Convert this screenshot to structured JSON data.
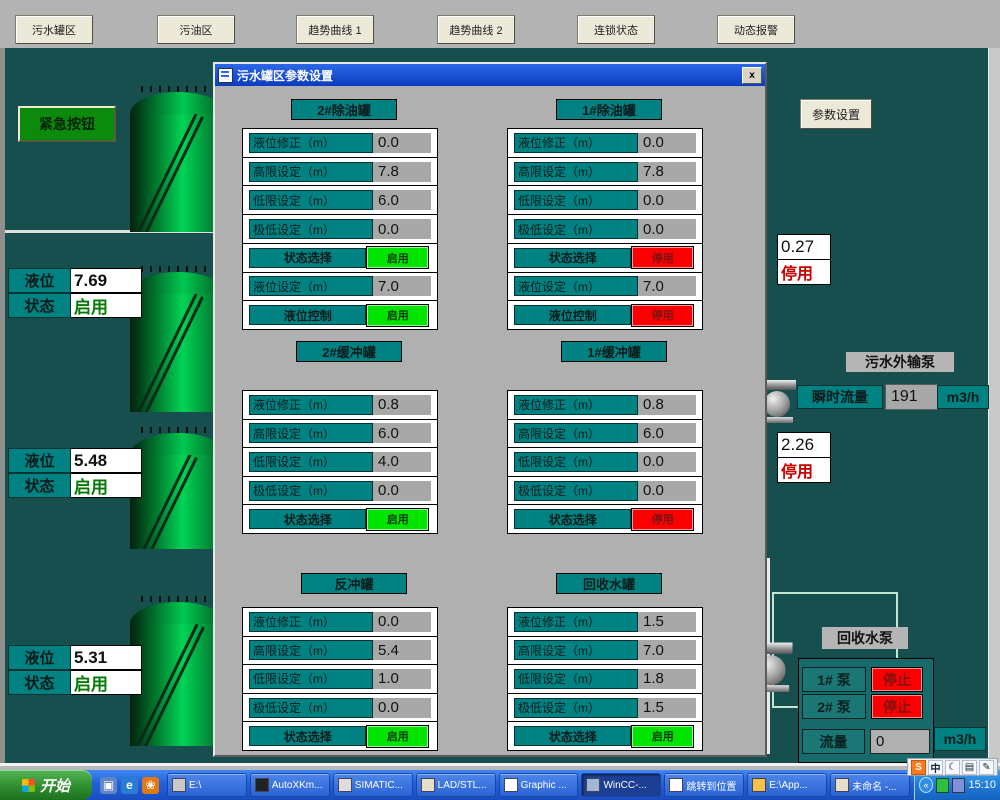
{
  "top_nav": {
    "buttons": [
      "污水罐区",
      "污油区",
      "趋势曲线 1",
      "趋势曲线 2",
      "连锁状态",
      "动态报警"
    ]
  },
  "left_panel": {
    "emergency_button": "紧急按钮",
    "tank_readouts": [
      {
        "level_label": "液位",
        "level_value": "7.69",
        "status_label": "状态",
        "status_value": "启用"
      },
      {
        "level_label": "液位",
        "level_value": "5.48",
        "status_label": "状态",
        "status_value": "启用"
      },
      {
        "level_label": "液位",
        "level_value": "5.31",
        "status_label": "状态",
        "status_value": "启用"
      }
    ]
  },
  "right_panel": {
    "params_button": "参数设置",
    "readouts": [
      {
        "value": "0.27",
        "status": "停用"
      },
      {
        "value": "2.26",
        "status": "停用"
      }
    ],
    "outflow_pump": {
      "title": "污水外输泵",
      "flow_label": "瞬时流量",
      "flow_value": "191",
      "flow_unit": "m3/h"
    },
    "recycle_pump": {
      "title": "回收水泵",
      "rows": [
        {
          "label": "1# 泵",
          "status": "停止"
        },
        {
          "label": "2# 泵",
          "status": "停止"
        }
      ],
      "flow_label": "流量",
      "flow_value": "0",
      "flow_unit": "m3/h"
    }
  },
  "dialog": {
    "title": "污水罐区参数设置",
    "close_label": "x",
    "groups": [
      {
        "title": "2#除油罐",
        "rows": [
          {
            "label": "液位修正（m）",
            "value": "0.0"
          },
          {
            "label": "高限设定（m）",
            "value": "7.8"
          },
          {
            "label": "低限设定（m）",
            "value": "6.0"
          },
          {
            "label": "极低设定（m）",
            "value": "0.0"
          },
          {
            "label": "状态选择",
            "button": "启用",
            "state": "on"
          },
          {
            "label": "液位设定（m）",
            "value": "7.0"
          },
          {
            "label": "液位控制",
            "button": "启用",
            "state": "on"
          }
        ]
      },
      {
        "title": "1#除油罐",
        "rows": [
          {
            "label": "液位修正（m）",
            "value": "0.0"
          },
          {
            "label": "高限设定（m）",
            "value": "7.8"
          },
          {
            "label": "低限设定（m）",
            "value": "0.0"
          },
          {
            "label": "极低设定（m）",
            "value": "0.0"
          },
          {
            "label": "状态选择",
            "button": "停用",
            "state": "off"
          },
          {
            "label": "液位设定（m）",
            "value": "7.0"
          },
          {
            "label": "液位控制",
            "button": "停用",
            "state": "off"
          }
        ]
      },
      {
        "title": "2#缓冲罐",
        "rows": [
          {
            "label": "液位修正（m）",
            "value": "0.8"
          },
          {
            "label": "高限设定（m）",
            "value": "6.0"
          },
          {
            "label": "低限设定（m）",
            "value": "4.0"
          },
          {
            "label": "极低设定（m）",
            "value": "0.0"
          },
          {
            "label": "状态选择",
            "button": "启用",
            "state": "on"
          }
        ]
      },
      {
        "title": "1#缓冲罐",
        "rows": [
          {
            "label": "液位修正（m）",
            "value": "0.8"
          },
          {
            "label": "高限设定（m）",
            "value": "6.0"
          },
          {
            "label": "低限设定（m）",
            "value": "0.0"
          },
          {
            "label": "极低设定（m）",
            "value": "0.0"
          },
          {
            "label": "状态选择",
            "button": "停用",
            "state": "off"
          }
        ]
      },
      {
        "title": "反冲罐",
        "rows": [
          {
            "label": "液位修正（m）",
            "value": "0.0"
          },
          {
            "label": "高限设定（m）",
            "value": "5.4"
          },
          {
            "label": "低限设定（m）",
            "value": "1.0"
          },
          {
            "label": "极低设定（m）",
            "value": "0.0"
          },
          {
            "label": "状态选择",
            "button": "启用",
            "state": "on"
          }
        ]
      },
      {
        "title": "回收水罐",
        "rows": [
          {
            "label": "液位修正（m）",
            "value": "1.5"
          },
          {
            "label": "高限设定（m）",
            "value": "7.0"
          },
          {
            "label": "低限设定（m）",
            "value": "1.8"
          },
          {
            "label": "极低设定（m）",
            "value": "1.5"
          },
          {
            "label": "状态选择",
            "button": "启用",
            "state": "on"
          }
        ]
      }
    ]
  },
  "taskbar": {
    "start_label": "开始",
    "quick_launch": [
      {
        "name": "desktop-icon",
        "glyph": "▣",
        "color": "#5f84c8"
      },
      {
        "name": "ie-icon",
        "glyph": "e",
        "color": "#2a7bd4"
      },
      {
        "name": "media-icon",
        "glyph": "❀",
        "color": "#e07818"
      }
    ],
    "tasks": [
      {
        "label": "E:\\",
        "icon": "drive-icon"
      },
      {
        "label": "AutoXKm...",
        "icon": "app-icon"
      },
      {
        "label": "SIMATIC...",
        "icon": "simatic-icon"
      },
      {
        "label": "LAD/STL...",
        "icon": "ladstl-icon"
      },
      {
        "label": "Graphic ...",
        "icon": "graphics-icon"
      },
      {
        "label": "WinCC-...",
        "icon": "wincc-icon",
        "active": true
      },
      {
        "label": "跳转到位置",
        "icon": "jump-icon"
      },
      {
        "label": "E:\\App...",
        "icon": "folder-icon"
      },
      {
        "label": "未命名 -...",
        "icon": "doc-icon"
      }
    ],
    "language_bar": [
      {
        "name": "sogou-icon",
        "glyph": "S"
      },
      {
        "name": "lang-zh-icon",
        "glyph": "中"
      },
      {
        "name": "ime-moon-icon",
        "glyph": "☾"
      },
      {
        "name": "keyboard-icon",
        "glyph": "▤"
      },
      {
        "name": "ime-tools-icon",
        "glyph": "✎"
      }
    ],
    "tray_time": "15:10"
  },
  "colors": {
    "background": "#174f4f",
    "teal_label": "#008283",
    "enabled_green": "#00e400",
    "disabled_red": "#fb0000",
    "title_bar_blue": "#0f4ad8",
    "dialog_grey": "#b0b0b0"
  }
}
